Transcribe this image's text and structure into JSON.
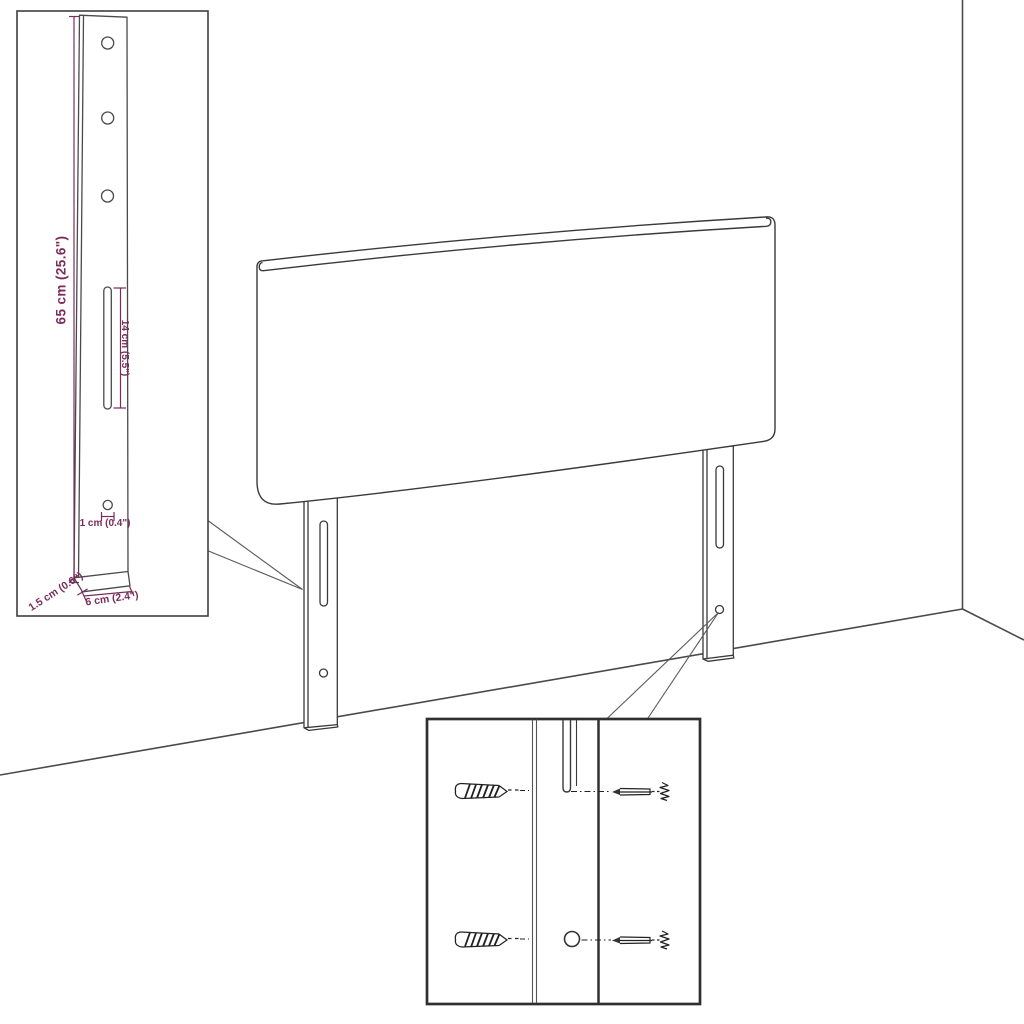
{
  "diagram": {
    "type": "furniture-assembly-dimension-diagram",
    "subject": "headboard-with-mounting-legs",
    "colors": {
      "background": "#ffffff",
      "outline": "#3a3a3a",
      "inset_border": "#3f3f3f",
      "dimension": "#7b2c5b"
    },
    "bracket_inset": {
      "height_label": "65 cm (25.6\")",
      "slot_label": "14 cm (5.5\")",
      "hole_label": "1 cm (0.4\")",
      "depth_label": "1.5 cm (0.6\")",
      "width_label": "6 cm (2.4\")"
    }
  }
}
